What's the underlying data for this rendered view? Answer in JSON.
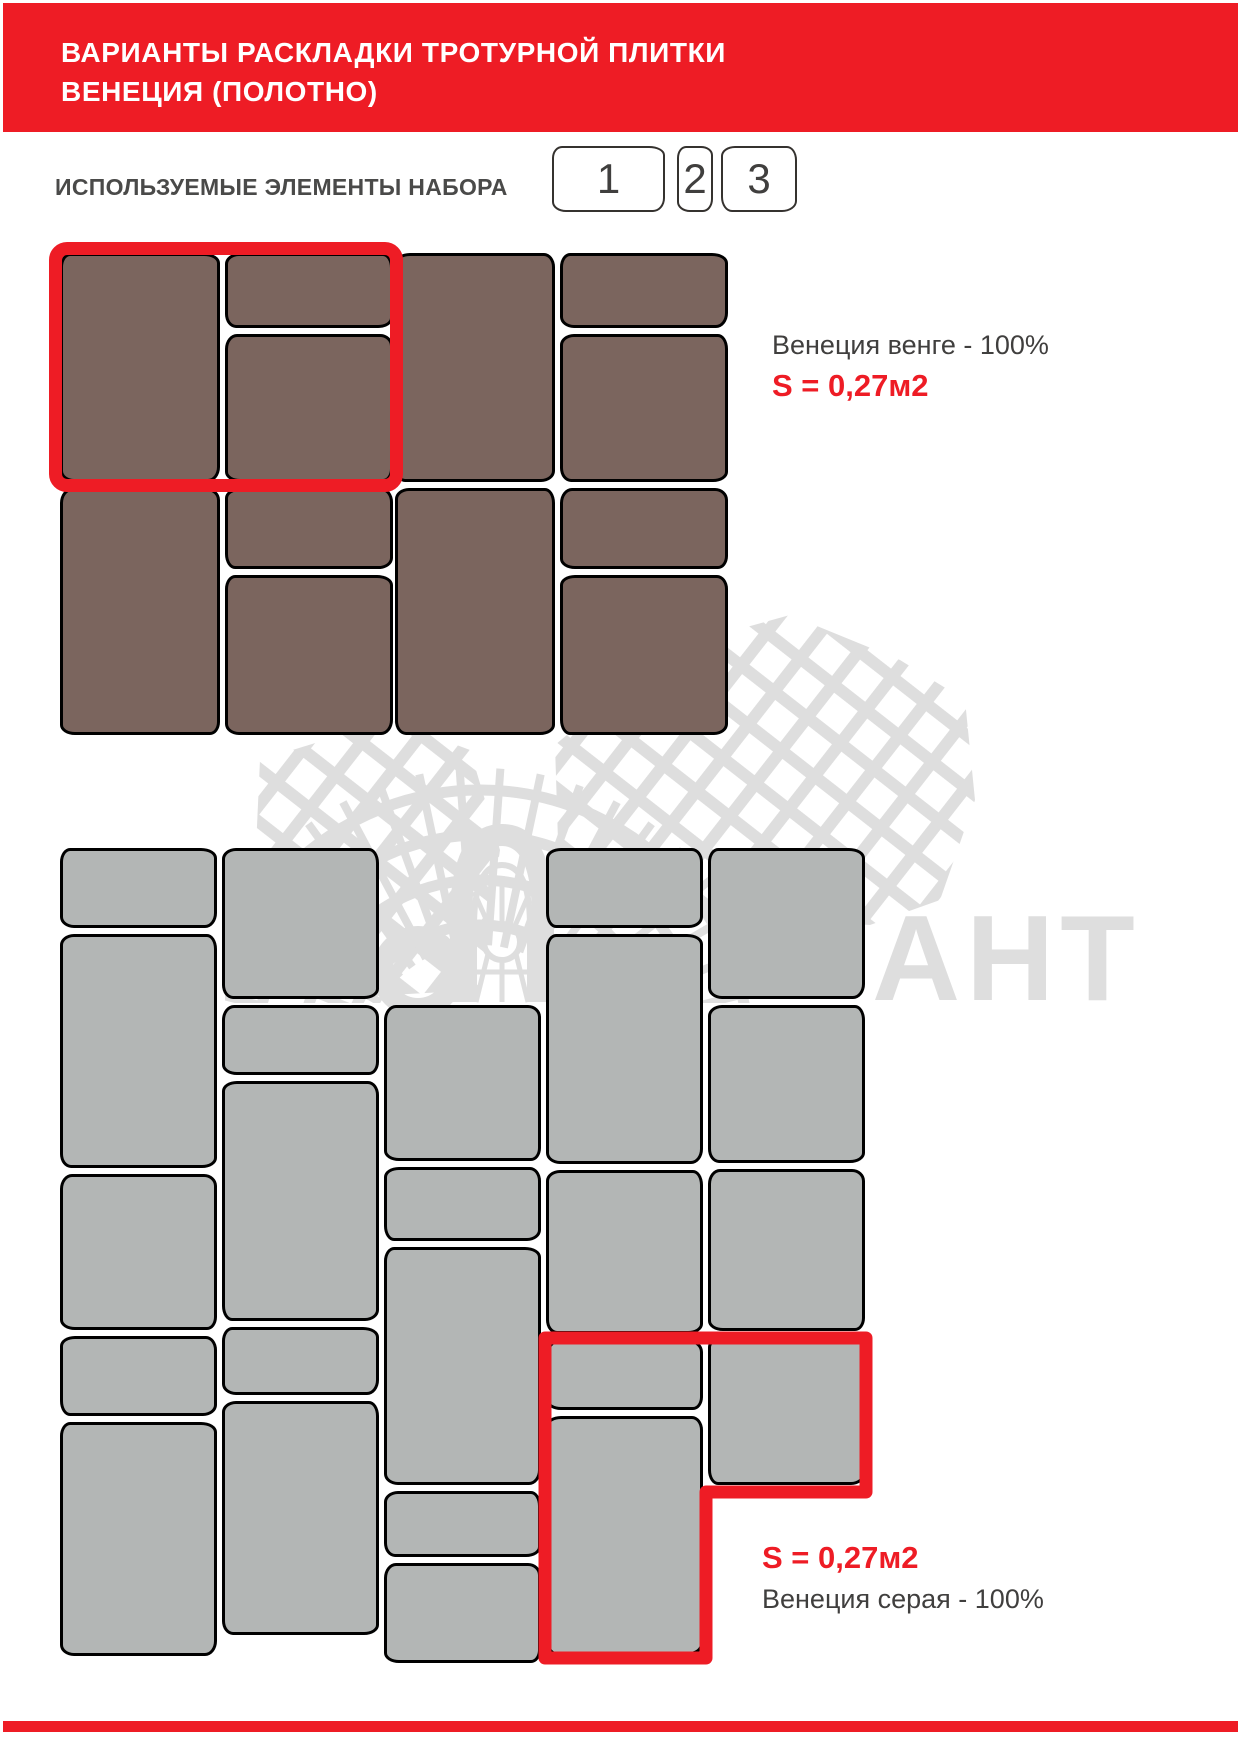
{
  "page": {
    "width": 1241,
    "height": 1755
  },
  "colors": {
    "accent_red": "#ee1c25",
    "brown_tile": "#7b655e",
    "gray_tile": "#b3b6b5",
    "text_dark": "#403f3e",
    "watermark_gray": "#dedede"
  },
  "header": {
    "title_line1": "ВАРИАНТЫ РАСКЛАДКИ ТРОТУРНОЙ ПЛИТКИ",
    "title_line2": "ВЕНЕЦИЯ (ПОЛОТНО)"
  },
  "elements_section": {
    "label": "ИСПОЛЬЗУЕМЫЕ ЭЛЕМЕНТЫ НАБОРА",
    "items": [
      {
        "number": "1"
      },
      {
        "number": "2"
      },
      {
        "number": "3"
      }
    ]
  },
  "brown_section": {
    "caption_name": "Венеция венге - 100%",
    "caption_area": "S = 0,27м2"
  },
  "gray_section": {
    "caption_area": "S = 0,27м2",
    "caption_name": "Венеция серая - 100%"
  },
  "watermark": {
    "letters": "АНТ"
  },
  "tile_layout": {
    "brown_tiles": [
      [
        60,
        253,
        160,
        229
      ],
      [
        225,
        253,
        168,
        75
      ],
      [
        225,
        334,
        168,
        148
      ],
      [
        395,
        253,
        160,
        229
      ],
      [
        560,
        253,
        168,
        75
      ],
      [
        560,
        334,
        168,
        148
      ],
      [
        60,
        488,
        160,
        247
      ],
      [
        225,
        488,
        168,
        81
      ],
      [
        225,
        575,
        168,
        160
      ],
      [
        395,
        488,
        160,
        247
      ],
      [
        560,
        488,
        168,
        81
      ],
      [
        560,
        575,
        168,
        160
      ]
    ],
    "gray_tiles": [
      [
        60,
        848,
        157,
        80
      ],
      [
        60,
        934,
        157,
        234
      ],
      [
        60,
        1174,
        157,
        156
      ],
      [
        60,
        1336,
        157,
        80
      ],
      [
        60,
        1422,
        157,
        234
      ],
      [
        222,
        848,
        157,
        151
      ],
      [
        222,
        1005,
        157,
        70
      ],
      [
        222,
        1081,
        157,
        240
      ],
      [
        222,
        1327,
        157,
        68
      ],
      [
        222,
        1401,
        157,
        234
      ],
      [
        384,
        1005,
        157,
        156
      ],
      [
        384,
        1167,
        157,
        74
      ],
      [
        384,
        1247,
        157,
        238
      ],
      [
        384,
        1491,
        157,
        66
      ],
      [
        384,
        1563,
        157,
        100
      ],
      [
        546,
        848,
        157,
        80
      ],
      [
        546,
        934,
        157,
        230
      ],
      [
        546,
        1170,
        157,
        164
      ],
      [
        546,
        1340,
        157,
        70
      ],
      [
        546,
        1416,
        157,
        239
      ],
      [
        708,
        848,
        157,
        151
      ],
      [
        708,
        1005,
        157,
        158
      ],
      [
        708,
        1169,
        157,
        162
      ],
      [
        708,
        1337,
        157,
        148
      ]
    ]
  }
}
